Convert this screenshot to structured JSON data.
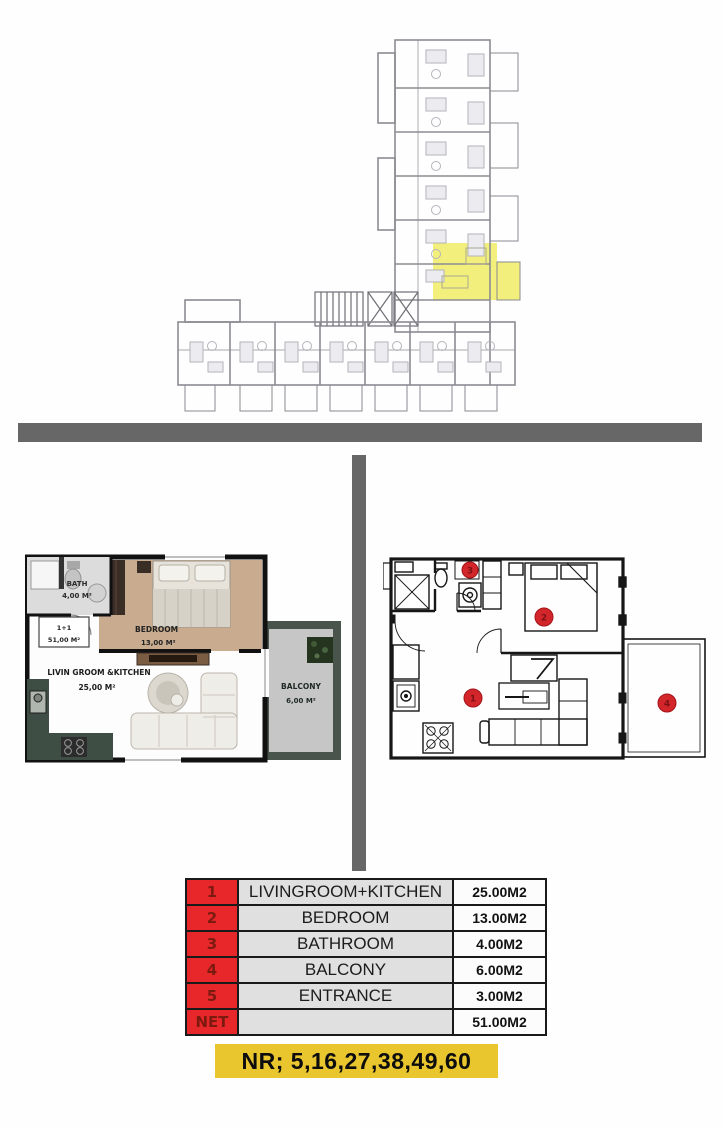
{
  "site_plan": {
    "description": "building-level-plan-with-highlighted-unit",
    "highlight_color": "#f2ef7d",
    "line_color": "#8b8b92"
  },
  "dividers": {
    "color": "#676767"
  },
  "left_plan": {
    "bath": {
      "label": "BATH",
      "area": "4,00 M²"
    },
    "unit": {
      "type": "1+1",
      "area": "51,00 M²"
    },
    "bedroom": {
      "label": "BEDROOM",
      "area": "13,00 M²"
    },
    "living": {
      "label": "LIVIN GROOM &KITCHEN",
      "area": "25,00 M²"
    },
    "balcony": {
      "label": "BALCONY",
      "area": "6,00 M²"
    }
  },
  "right_plan": {
    "marker_color": "#d2262b",
    "markers": [
      {
        "label": "1",
        "room": "livingroom-kitchen"
      },
      {
        "label": "2",
        "room": "bedroom"
      },
      {
        "label": "3",
        "room": "bathroom"
      },
      {
        "label": "4",
        "room": "balcony"
      }
    ]
  },
  "area_table": {
    "num_bg": "#e8272b",
    "name_bg": "#e0e0e0",
    "size_bg": "#fcfcfc",
    "rows": [
      {
        "num": "1",
        "name": "LIVINGROOM+KITCHEN",
        "size": "25.00M2"
      },
      {
        "num": "2",
        "name": "BEDROOM",
        "size": "13.00M2"
      },
      {
        "num": "3",
        "name": "BATHROOM",
        "size": "4.00M2"
      },
      {
        "num": "4",
        "name": "BALCONY",
        "size": "6.00M2"
      },
      {
        "num": "5",
        "name": "ENTRANCE",
        "size": "3.00M2"
      },
      {
        "num": "NET",
        "name": "",
        "size": "51.00M2"
      }
    ]
  },
  "banner": {
    "text": "NR; 5,16,27,38,49,60",
    "bg": "#e9c52e"
  }
}
